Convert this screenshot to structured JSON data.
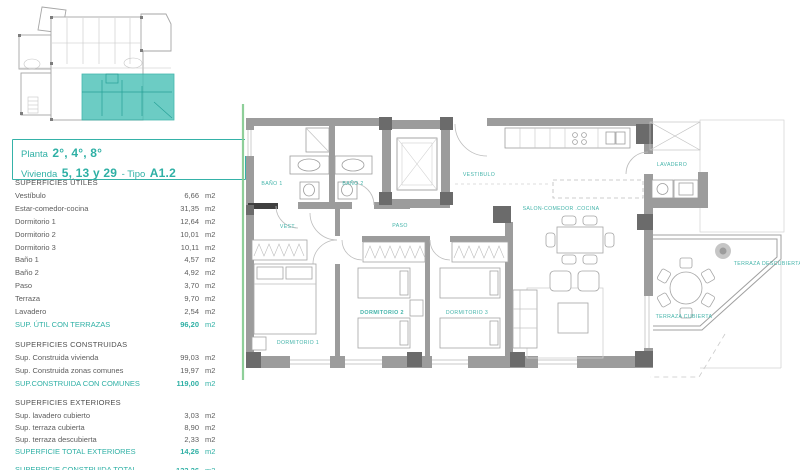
{
  "title": {
    "line1_prefix": "Planta",
    "line1_value": "2°, 4°, 8°",
    "line2_prefix": "Vivienda",
    "line2_value": "5, 13 y 29",
    "line2_sep": "- Tipo",
    "line2_type": "A1.2"
  },
  "surfaces": {
    "utiles": {
      "header": "SUPERFICIES ÚTILES",
      "rows": [
        {
          "label": "Vestíbulo",
          "value": "6,66",
          "unit": "m2"
        },
        {
          "label": "Estar-comedor-cocina",
          "value": "31,35",
          "unit": "m2"
        },
        {
          "label": "Dormitorio 1",
          "value": "12,64",
          "unit": "m2"
        },
        {
          "label": "Dormitorio 2",
          "value": "10,01",
          "unit": "m2"
        },
        {
          "label": "Dormitorio 3",
          "value": "10,11",
          "unit": "m2"
        },
        {
          "label": "Baño 1",
          "value": "4,57",
          "unit": "m2"
        },
        {
          "label": "Baño 2",
          "value": "4,92",
          "unit": "m2"
        },
        {
          "label": "Paso",
          "value": "3,70",
          "unit": "m2"
        },
        {
          "label": "Terraza",
          "value": "9,70",
          "unit": "m2"
        },
        {
          "label": "Lavadero",
          "value": "2,54",
          "unit": "m2"
        },
        {
          "label": "SUP. ÚTIL CON TERRAZAS",
          "value": "96,20",
          "unit": "m2",
          "total": true
        }
      ]
    },
    "construidas": {
      "header": "SUPERFICIES CONSTRUIDAS",
      "rows": [
        {
          "label": "Sup. Construida vivienda",
          "value": "99,03",
          "unit": "m2"
        },
        {
          "label": "Sup. Construida zonas comunes",
          "value": "19,97",
          "unit": "m2"
        },
        {
          "label": "SUP.CONSTRUIDA CON COMUNES",
          "value": "119,00",
          "unit": "m2",
          "total": true
        }
      ]
    },
    "exteriores": {
      "header": "SUPERFICIES EXTERIORES",
      "rows": [
        {
          "label": "Sup. lavadero cubierto",
          "value": "3,03",
          "unit": "m2"
        },
        {
          "label": "Sup. terraza cubierta",
          "value": "8,90",
          "unit": "m2"
        },
        {
          "label": "Sup. terraza descubierta",
          "value": "2,33",
          "unit": "m2"
        },
        {
          "label": "SUPERFICIE TOTAL EXTERIORES",
          "value": "14,26",
          "unit": "m2",
          "total": true
        }
      ]
    },
    "grand_total": {
      "label_line1": "SUPERFICIE CONSTRUIDA TOTAL",
      "label_line2": "CON SUPERFICIES EXTERIORES",
      "value": "133,26",
      "unit": "m2"
    }
  },
  "plan": {
    "labels": {
      "bano1": "BAÑO 1",
      "bano2": "BAÑO 2",
      "vestibulo": "VESTIBULO",
      "vest": "VEST.",
      "paso": "PASO",
      "salon": "SALON-COMEDOR .COCINA",
      "lavadero": "LAVADERO",
      "dorm1": "DORMITORIO 1",
      "dorm2": "DORMITORIO 2",
      "dorm3": "DORMITORIO 3",
      "terraza_cubierta": "TERRAZA CUBIERTA",
      "terraza_descubierta": "TERRAZA DESCUBIERTA"
    }
  },
  "colors": {
    "accent_teal": "#2fb0a5",
    "keyplan_highlight": "#4cc2b8",
    "wall_gray": "#9c9c9c",
    "pillar_gray": "#6b6b6b",
    "party_wall_green": "#82ca8e"
  }
}
